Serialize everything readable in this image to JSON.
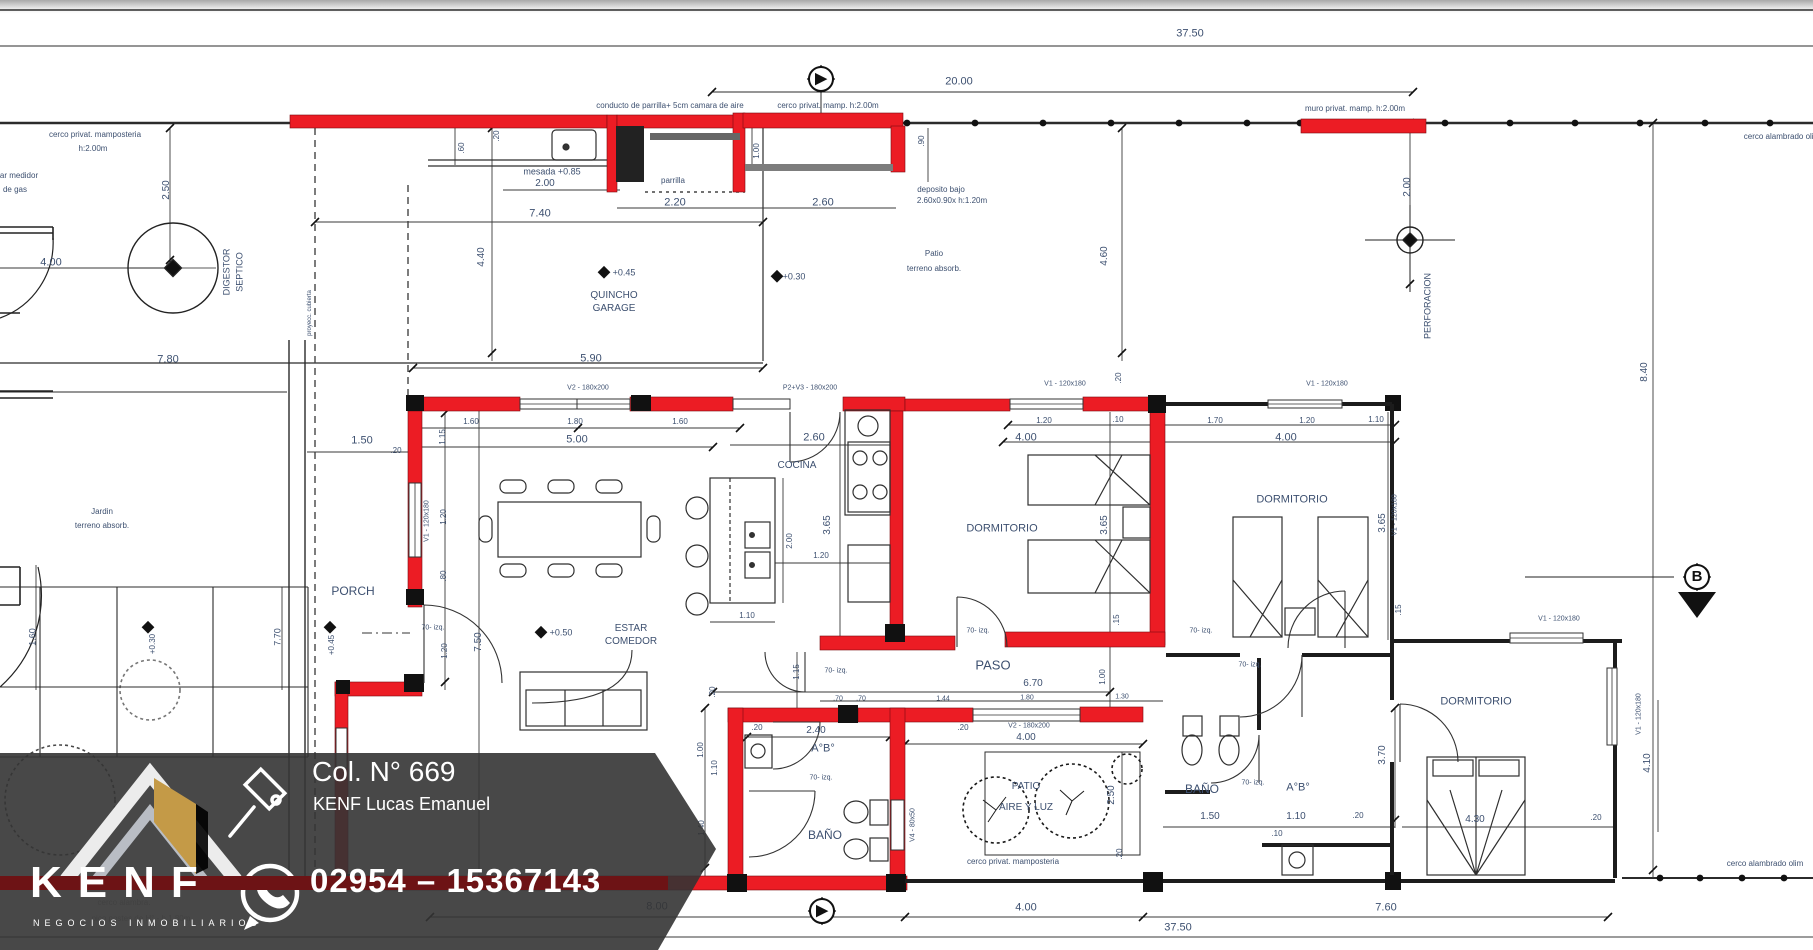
{
  "title": "Plano de planta - vivienda",
  "colors": {
    "wall_red": "#ec1c24",
    "line": "#2b2b2b",
    "dim_text": "#3d5070",
    "banner_bg": "rgba(52,52,52,0.9)",
    "banner_text": "#ffffff",
    "gold": "#c49a47"
  },
  "banner": {
    "license": "Col. N° 669",
    "agent": "KENF Lucas Emanuel",
    "phone": "02954 – 15367143",
    "brand": "KENF",
    "tagline": "NEGOCIOS INMOBILIARIOS",
    "icons": [
      "gavel-icon",
      "whatsapp-phone-icon",
      "roof-logo"
    ]
  },
  "section_markers": [
    {
      "id": "A-top",
      "x": 821,
      "y": 79,
      "glyph": "▶"
    },
    {
      "id": "A-bottom",
      "x": 822,
      "y": 911,
      "glyph": "▶"
    },
    {
      "id": "B-right",
      "x": 1697,
      "y": 577,
      "glyph": "B"
    }
  ],
  "labels": [
    {
      "t": "37.50",
      "x": 1190,
      "y": 34,
      "s": 11
    },
    {
      "t": "20.00",
      "x": 959,
      "y": 82,
      "s": 11
    },
    {
      "t": "cerco privat. mamposteria",
      "x": 95,
      "y": 135,
      "s": 8
    },
    {
      "t": "h:2.00m",
      "x": 93,
      "y": 149,
      "s": 8
    },
    {
      "t": "ar medidor",
      "x": 19,
      "y": 176,
      "s": 8
    },
    {
      "t": "de gas",
      "x": 15,
      "y": 190,
      "s": 8
    },
    {
      "t": "conducto de parrilla+ 5cm camara de aire",
      "x": 670,
      "y": 106,
      "s": 8
    },
    {
      "t": "cerco privat. mamp. h:2.00m",
      "x": 828,
      "y": 106,
      "s": 8
    },
    {
      "t": "muro privat. mamp. h:2.00m",
      "x": 1355,
      "y": 109,
      "s": 8
    },
    {
      "t": "cerco alambrado olim",
      "x": 1782,
      "y": 137,
      "s": 8
    },
    {
      "t": "mesada +0.85",
      "x": 552,
      "y": 172,
      "s": 9
    },
    {
      "t": "2.00",
      "x": 545,
      "y": 184,
      "s": 10
    },
    {
      "t": "7.40",
      "x": 540,
      "y": 214,
      "s": 11
    },
    {
      "t": "parrilla",
      "x": 673,
      "y": 181,
      "s": 8
    },
    {
      "t": "2.20",
      "x": 675,
      "y": 203,
      "s": 11
    },
    {
      "t": "2.60",
      "x": 823,
      "y": 203,
      "s": 11
    },
    {
      "t": "deposito bajo",
      "x": 941,
      "y": 190,
      "s": 8
    },
    {
      "t": "2.60x0.90x h:1.20m",
      "x": 952,
      "y": 201,
      "s": 8
    },
    {
      "t": "+0.45",
      "x": 624,
      "y": 273,
      "s": 9
    },
    {
      "t": "QUINCHO",
      "x": 614,
      "y": 296,
      "s": 10
    },
    {
      "t": "GARAGE",
      "x": 614,
      "y": 309,
      "s": 10
    },
    {
      "t": "Patio",
      "x": 934,
      "y": 254,
      "s": 8
    },
    {
      "t": "terreno absorb.",
      "x": 934,
      "y": 269,
      "s": 8
    },
    {
      "t": "4.00",
      "x": 51,
      "y": 263,
      "s": 11
    },
    {
      "t": "7.80",
      "x": 168,
      "y": 360,
      "s": 11
    },
    {
      "t": "5.90",
      "x": 591,
      "y": 359,
      "s": 11
    },
    {
      "t": "V2 - 180x200",
      "x": 588,
      "y": 388,
      "s": 7
    },
    {
      "t": "P2+V3 - 180x200",
      "x": 810,
      "y": 388,
      "s": 7
    },
    {
      "t": "V1 - 120x180",
      "x": 1065,
      "y": 384,
      "s": 7
    },
    {
      "t": "V1 - 120x180",
      "x": 1327,
      "y": 384,
      "s": 7
    },
    {
      "t": "V1 - 120x180",
      "x": 1559,
      "y": 619,
      "s": 7
    },
    {
      "t": "1.60",
      "x": 471,
      "y": 422,
      "s": 8
    },
    {
      "t": "1.80",
      "x": 575,
      "y": 422,
      "s": 8
    },
    {
      "t": "1.60",
      "x": 680,
      "y": 422,
      "s": 8
    },
    {
      "t": "5.00",
      "x": 577,
      "y": 440,
      "s": 11
    },
    {
      "t": "2.60",
      "x": 814,
      "y": 438,
      "s": 11
    },
    {
      "t": "1.20",
      "x": 1044,
      "y": 421,
      "s": 8
    },
    {
      "t": ".10",
      "x": 1118,
      "y": 420,
      "s": 8
    },
    {
      "t": "1.70",
      "x": 1215,
      "y": 421,
      "s": 8
    },
    {
      "t": "1.20",
      "x": 1307,
      "y": 421,
      "s": 8
    },
    {
      "t": "1.10",
      "x": 1376,
      "y": 420,
      "s": 8
    },
    {
      "t": "4.00",
      "x": 1026,
      "y": 438,
      "s": 11
    },
    {
      "t": "4.00",
      "x": 1286,
      "y": 438,
      "s": 11
    },
    {
      "t": "1.50",
      "x": 362,
      "y": 441,
      "s": 11
    },
    {
      "t": ".20",
      "x": 396,
      "y": 451,
      "s": 8
    },
    {
      "t": "Jardin",
      "x": 102,
      "y": 512,
      "s": 8
    },
    {
      "t": "terreno absorb.",
      "x": 102,
      "y": 526,
      "s": 8
    },
    {
      "t": "PORCH",
      "x": 353,
      "y": 591,
      "s": 12
    },
    {
      "t": "COCINA",
      "x": 797,
      "y": 466,
      "s": 10
    },
    {
      "t": "DORMITORIO",
      "x": 1002,
      "y": 529,
      "s": 11
    },
    {
      "t": "DORMITORIO",
      "x": 1292,
      "y": 500,
      "s": 11
    },
    {
      "t": "DORMITORIO",
      "x": 1476,
      "y": 702,
      "s": 11
    },
    {
      "t": "ESTAR",
      "x": 631,
      "y": 629,
      "s": 10
    },
    {
      "t": "COMEDOR",
      "x": 631,
      "y": 642,
      "s": 10
    },
    {
      "t": "+0.50",
      "x": 561,
      "y": 633,
      "s": 9
    },
    {
      "t": "+0.30",
      "x": 794,
      "y": 277,
      "s": 9
    },
    {
      "t": "PASO",
      "x": 993,
      "y": 665,
      "s": 13
    },
    {
      "t": "6.70",
      "x": 1033,
      "y": 684,
      "s": 10
    },
    {
      "t": "1.80",
      "x": 1027,
      "y": 698,
      "s": 7
    },
    {
      "t": "1.30",
      "x": 1122,
      "y": 697,
      "s": 7
    },
    {
      "t": ".70",
      "x": 838,
      "y": 699,
      "s": 7
    },
    {
      "t": ".70",
      "x": 861,
      "y": 699,
      "s": 7
    },
    {
      "t": "1.44",
      "x": 943,
      "y": 699,
      "s": 7
    },
    {
      "t": "2.40",
      "x": 816,
      "y": 731,
      "s": 10
    },
    {
      "t": ".20",
      "x": 757,
      "y": 728,
      "s": 8
    },
    {
      "t": ".20",
      "x": 963,
      "y": 728,
      "s": 8
    },
    {
      "t": "A°B°",
      "x": 823,
      "y": 749,
      "s": 11
    },
    {
      "t": "BAÑO",
      "x": 825,
      "y": 835,
      "s": 12
    },
    {
      "t": "BAÑO",
      "x": 1202,
      "y": 789,
      "s": 12
    },
    {
      "t": "A°B°",
      "x": 1298,
      "y": 788,
      "s": 11
    },
    {
      "t": "V2 - 180x200",
      "x": 1029,
      "y": 726,
      "s": 7
    },
    {
      "t": "4.00",
      "x": 1026,
      "y": 738,
      "s": 10
    },
    {
      "t": "PATIO",
      "x": 1026,
      "y": 787,
      "s": 10
    },
    {
      "t": "AIRE Y LUZ",
      "x": 1026,
      "y": 808,
      "s": 10
    },
    {
      "t": "cerco privat. mamposteria",
      "x": 1013,
      "y": 862,
      "s": 8
    },
    {
      "t": "1.50",
      "x": 1210,
      "y": 817,
      "s": 10
    },
    {
      "t": "1.10",
      "x": 1296,
      "y": 817,
      "s": 10
    },
    {
      "t": ".10",
      "x": 1277,
      "y": 834,
      "s": 8
    },
    {
      "t": ".20",
      "x": 1358,
      "y": 816,
      "s": 8
    },
    {
      "t": "4.30",
      "x": 1475,
      "y": 820,
      "s": 10
    },
    {
      "t": ".20",
      "x": 1596,
      "y": 818,
      "s": 8
    },
    {
      "t": "8.00",
      "x": 657,
      "y": 907,
      "s": 11
    },
    {
      "t": "4.00",
      "x": 1026,
      "y": 908,
      "s": 11
    },
    {
      "t": "7.60",
      "x": 1386,
      "y": 908,
      "s": 11
    },
    {
      "t": "37.50",
      "x": 1178,
      "y": 928,
      "s": 11
    },
    {
      "t": "cerco alambrado olim",
      "x": 1765,
      "y": 864,
      "s": 8
    },
    {
      "t": "1.20",
      "x": 821,
      "y": 556,
      "s": 8
    },
    {
      "t": "1.10",
      "x": 747,
      "y": 616,
      "s": 8
    },
    {
      "t": "70- izq.",
      "x": 433,
      "y": 628,
      "s": 7
    },
    {
      "t": "70- izq.",
      "x": 836,
      "y": 671,
      "s": 7
    },
    {
      "t": "70- izq.",
      "x": 978,
      "y": 631,
      "s": 7
    },
    {
      "t": "70- izq.",
      "x": 1201,
      "y": 631,
      "s": 7
    },
    {
      "t": "70- izq.",
      "x": 1250,
      "y": 665,
      "s": 7
    },
    {
      "t": "70- izq.",
      "x": 821,
      "y": 778,
      "s": 7
    },
    {
      "t": "70- izq.",
      "x": 1253,
      "y": 783,
      "s": 7
    },
    {
      "t": "2.50",
      "x": 167,
      "y": 190,
      "r": -90,
      "s": 10
    },
    {
      "t": "DIGESTOR",
      "x": 227,
      "y": 272,
      "r": -90,
      "s": 9
    },
    {
      "t": "SEPTICO",
      "x": 240,
      "y": 272,
      "r": -90,
      "s": 9
    },
    {
      "t": "4.40",
      "x": 482,
      "y": 257,
      "r": -90,
      "s": 10
    },
    {
      "t": ".60",
      "x": 462,
      "y": 148,
      "r": -90,
      "s": 8
    },
    {
      "t": ".20",
      "x": 497,
      "y": 136,
      "r": -90,
      "s": 8
    },
    {
      "t": "1.00",
      "x": 757,
      "y": 151,
      "r": -90,
      "s": 8
    },
    {
      "t": ".90",
      "x": 922,
      "y": 141,
      "r": -90,
      "s": 8
    },
    {
      "t": "4.60",
      "x": 1105,
      "y": 256,
      "r": -90,
      "s": 10
    },
    {
      "t": "2.00",
      "x": 1408,
      "y": 187,
      "r": -90,
      "s": 10
    },
    {
      "t": "PERFORACION",
      "x": 1428,
      "y": 306,
      "r": -90,
      "s": 9
    },
    {
      "t": "8.40",
      "x": 1645,
      "y": 372,
      "r": -90,
      "s": 10
    },
    {
      "t": "proyecc. cubierta",
      "x": 310,
      "y": 313,
      "r": -90,
      "s": 6
    },
    {
      "t": "V1 - 120x180",
      "x": 427,
      "y": 521,
      "r": -90,
      "s": 7
    },
    {
      "t": "1.15",
      "x": 443,
      "y": 437,
      "r": -90,
      "s": 8
    },
    {
      "t": "1.20",
      "x": 444,
      "y": 517,
      "r": -90,
      "s": 8
    },
    {
      "t": ".80",
      "x": 444,
      "y": 576,
      "r": -90,
      "s": 8
    },
    {
      "t": "1.20",
      "x": 445,
      "y": 651,
      "r": -90,
      "s": 8
    },
    {
      "t": "7.50",
      "x": 479,
      "y": 642,
      "r": -90,
      "s": 10
    },
    {
      "t": "3.65",
      "x": 828,
      "y": 525,
      "r": -90,
      "s": 10
    },
    {
      "t": "2.00",
      "x": 790,
      "y": 541,
      "r": -90,
      "s": 8
    },
    {
      "t": "3.65",
      "x": 1105,
      "y": 525,
      "r": -90,
      "s": 10
    },
    {
      "t": "3.65",
      "x": 1383,
      "y": 523,
      "r": -90,
      "s": 10
    },
    {
      "t": "V1 - 120x180",
      "x": 1395,
      "y": 515,
      "r": -90,
      "s": 7
    },
    {
      "t": ".20",
      "x": 1119,
      "y": 378,
      "r": -90,
      "s": 8
    },
    {
      "t": ".15",
      "x": 1117,
      "y": 620,
      "r": -90,
      "s": 8
    },
    {
      "t": ".15",
      "x": 1399,
      "y": 610,
      "r": -90,
      "s": 8
    },
    {
      "t": "1.00",
      "x": 1103,
      "y": 677,
      "r": -90,
      "s": 8
    },
    {
      "t": "1.15",
      "x": 797,
      "y": 672,
      "r": -90,
      "s": 8
    },
    {
      "t": ".20",
      "x": 713,
      "y": 692,
      "r": -90,
      "s": 8
    },
    {
      "t": "1.00",
      "x": 701,
      "y": 750,
      "r": -90,
      "s": 8
    },
    {
      "t": "1.10",
      "x": 715,
      "y": 768,
      "r": -90,
      "s": 8
    },
    {
      "t": "1.40",
      "x": 702,
      "y": 828,
      "r": -90,
      "s": 8
    },
    {
      "t": ".20",
      "x": 1120,
      "y": 854,
      "r": -90,
      "s": 8
    },
    {
      "t": "2.50",
      "x": 1112,
      "y": 795,
      "r": -90,
      "s": 10
    },
    {
      "t": "V4 - 80x50",
      "x": 913,
      "y": 825,
      "r": -90,
      "s": 7
    },
    {
      "t": "3.70",
      "x": 1383,
      "y": 755,
      "r": -90,
      "s": 10
    },
    {
      "t": "4.10",
      "x": 1648,
      "y": 763,
      "r": -90,
      "s": 10
    },
    {
      "t": "V1 - 120x180",
      "x": 1639,
      "y": 714,
      "r": -90,
      "s": 7
    },
    {
      "t": "1.60",
      "x": 33,
      "y": 637,
      "r": -90,
      "s": 9
    },
    {
      "t": "7.70",
      "x": 278,
      "y": 637,
      "r": -90,
      "s": 9
    },
    {
      "t": "+0.30",
      "x": 153,
      "y": 644,
      "r": -90,
      "s": 8
    },
    {
      "t": "+0.45",
      "x": 332,
      "y": 645,
      "r": -90,
      "s": 8
    },
    {
      "t": "cerco alambra.",
      "x": 124,
      "y": 903,
      "s": 8,
      "f": 1
    },
    {
      "t": "pico postes de H° - h 1.80m",
      "x": 141,
      "y": 919,
      "s": 8,
      "f": 1
    }
  ]
}
